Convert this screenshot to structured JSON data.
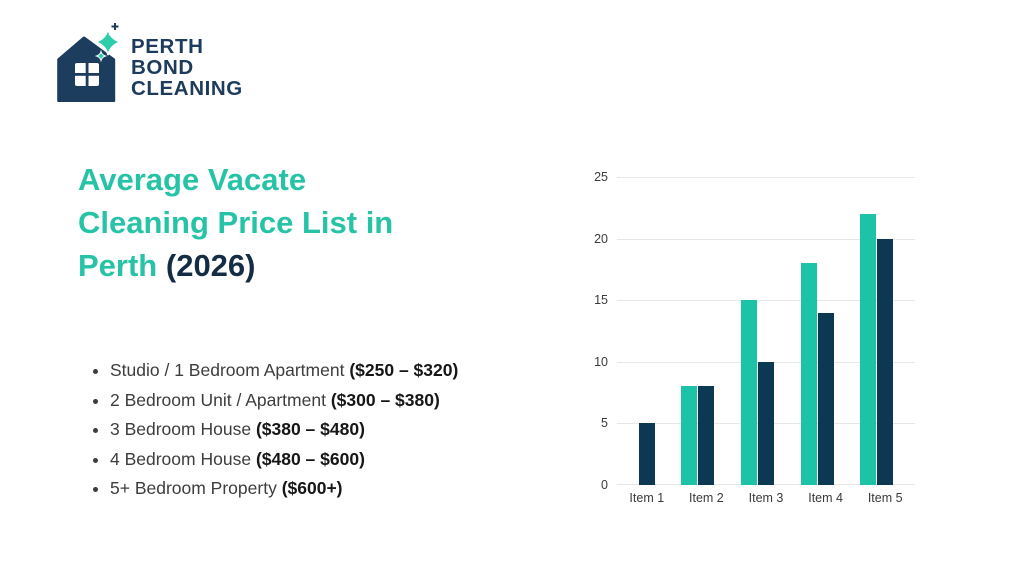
{
  "logo": {
    "line1": "PERTH",
    "line2": "BOND",
    "line3": "CLEANING",
    "text_color": "#1C3B5D",
    "house_color": "#1D3D5F",
    "sparkle_color": "#2BCDAA"
  },
  "title": {
    "lines": [
      "Average Vacate",
      "Cleaning Price List in",
      "Perth"
    ],
    "year_suffix": "(2026)",
    "teal_color": "#27C3A7",
    "suffix_color": "#142C44"
  },
  "price_list": {
    "items": [
      {
        "label": "Studio / 1 Bedroom Apartment",
        "price": "($250 – $320)"
      },
      {
        "label": "2 Bedroom Unit / Apartment",
        "price": "($300 – $380)"
      },
      {
        "label": "3 Bedroom House",
        "price": "($380 – $480)"
      },
      {
        "label": "4 Bedroom House",
        "price": "($480 – $600)"
      },
      {
        "label": "5+ Bedroom Property",
        "price": "($600+)"
      }
    ]
  },
  "chart_data": {
    "type": "bar",
    "categories": [
      "Item 1",
      "Item 2",
      "Item 3",
      "Item 4",
      "Item 5"
    ],
    "series": [
      {
        "name": "series-a",
        "color": "#1DC3A6",
        "values": [
          0,
          8,
          15,
          18,
          22
        ]
      },
      {
        "name": "series-b",
        "color": "#0D3854",
        "values": [
          5,
          8,
          10,
          14,
          20
        ]
      }
    ],
    "title": "",
    "xlabel": "",
    "ylabel": "",
    "ylim": [
      0,
      25
    ],
    "yticks": [
      0,
      5,
      10,
      15,
      20,
      25
    ],
    "grid": true,
    "legend": "none",
    "gridline_color": "#E7E7E7",
    "tick_label_color": "#3A3A3A"
  }
}
